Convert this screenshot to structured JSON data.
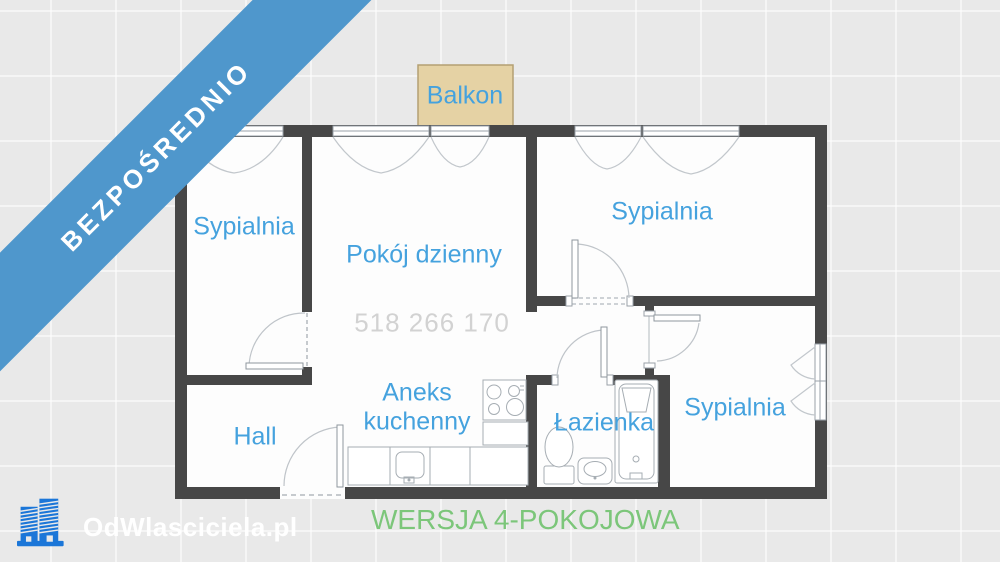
{
  "banner": {
    "label": "BEZPOŚREDNIO"
  },
  "plan": {
    "balcony_label": "Balkon",
    "bedroom_top_left": "Sypialnia",
    "living_room": "Pokój dzienny",
    "bedroom_top_right": "Sypialnia",
    "bedroom_bottom_right": "Sypialnia",
    "hall": "Hall",
    "kitchen_line1": "Aneks",
    "kitchen_line2": "kuchenny",
    "bathroom": "Łazienka",
    "phone_watermark": "518 266 170"
  },
  "footer": {
    "brand": "OdWlasciciela.pl",
    "version": "WERSJA 4-POKOJOWA",
    "logo_icon": "buildings-icon"
  },
  "colors": {
    "background": "#e9e9e9",
    "ribbon_blue": "#4f97cc",
    "label_blue": "#45a2de",
    "wall_dark": "#474747",
    "balcony_fill": "#e5d2a4",
    "balcony_border": "#b4a073",
    "watermark_gray": "#d2d2d2",
    "version_green": "#7cc67a",
    "brand_white": "#ffffff",
    "logo_blue": "#1b76d8"
  }
}
